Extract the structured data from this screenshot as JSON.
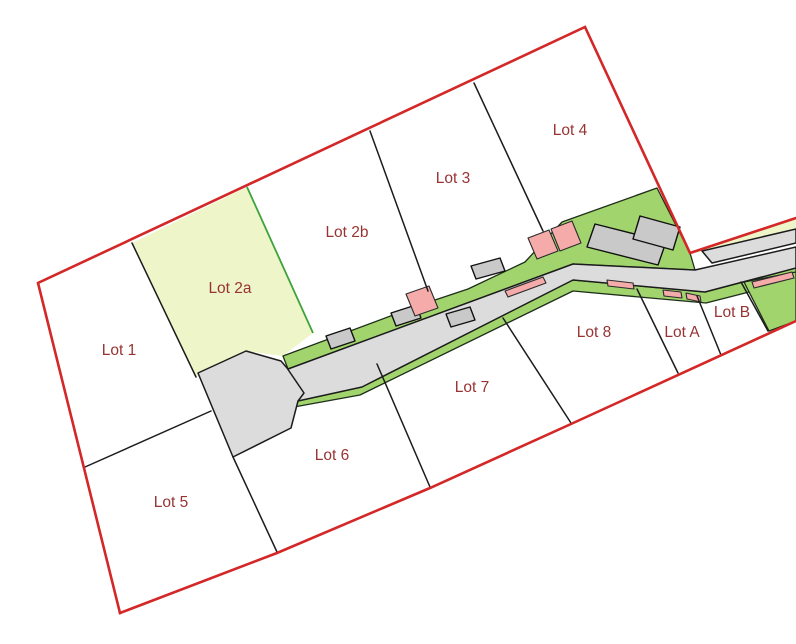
{
  "map": {
    "kind": "subdivision-site-plan",
    "highlighted_lot": "Lot 2a",
    "features": {
      "boundary": "red site boundary",
      "road": "gray access road with turnaround",
      "verges": "green landscape strips along road",
      "driveway_markers": "pink crossing markers",
      "buildings": "gray building footprints"
    }
  },
  "lots": [
    {
      "label": "Lot 1"
    },
    {
      "label": "Lot 2a"
    },
    {
      "label": "Lot 2b"
    },
    {
      "label": "Lot 3"
    },
    {
      "label": "Lot 4"
    },
    {
      "label": "Lot 5"
    },
    {
      "label": "Lot 6"
    },
    {
      "label": "Lot 7"
    },
    {
      "label": "Lot 8"
    },
    {
      "label": "Lot A"
    },
    {
      "label": "Lot B"
    }
  ],
  "colors": {
    "boundary_red": "#d42727",
    "lot_line_black": "#1c1c1c",
    "parcel_white": "#ffffff",
    "lot2a_pale_green": "#eef6c9",
    "verge_green": "#a2d46e",
    "green_lot_line": "#3da33a",
    "road_gray": "#dcdcdc",
    "building_gray": "#c9c9c9",
    "driveway_pink": "#f4aba9",
    "label_dark_red": "#993333"
  }
}
